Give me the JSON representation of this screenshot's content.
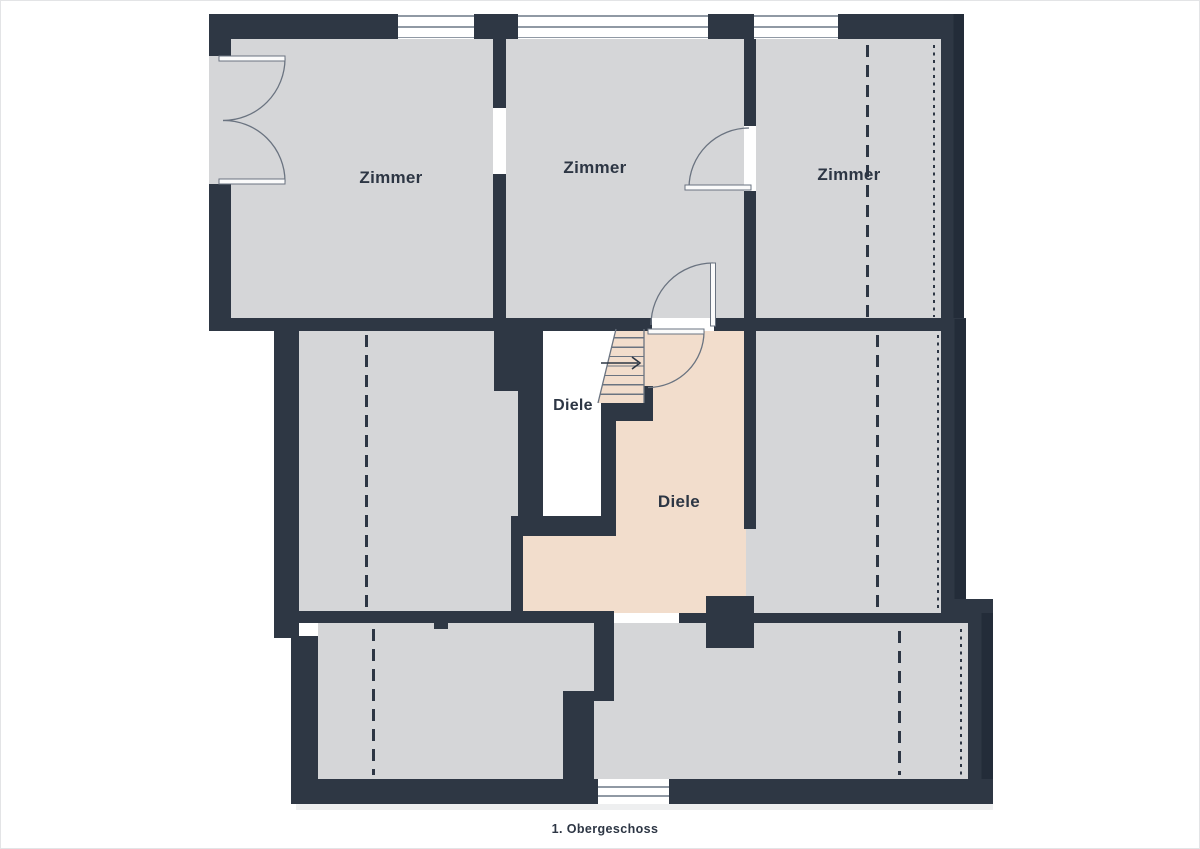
{
  "floor_plan": {
    "caption": "1. Obergeschoss",
    "labels": {
      "zimmer_top_left": "Zimmer",
      "zimmer_top_middle": "Zimmer",
      "zimmer_top_right": "Zimmer",
      "diele_stairwell": "Diele",
      "diele_hall": "Diele"
    },
    "icons": {
      "stair_direction_arrow": "arrow-right",
      "doors": "quarter-circle-swing-arcs",
      "windows": "double-line-glazing",
      "roof_slope_lines": "dashed-and-dotted"
    }
  },
  "theme": {
    "wall": "#2e3744",
    "wallShadow": "#232c39",
    "room": "#d5d6d8",
    "hall": "#f2ddcc",
    "void": "#ffffff",
    "line": "#6a7380",
    "glass": "#9099a4",
    "text": "#2d3644",
    "pageBorder": "#e3e4e6"
  }
}
